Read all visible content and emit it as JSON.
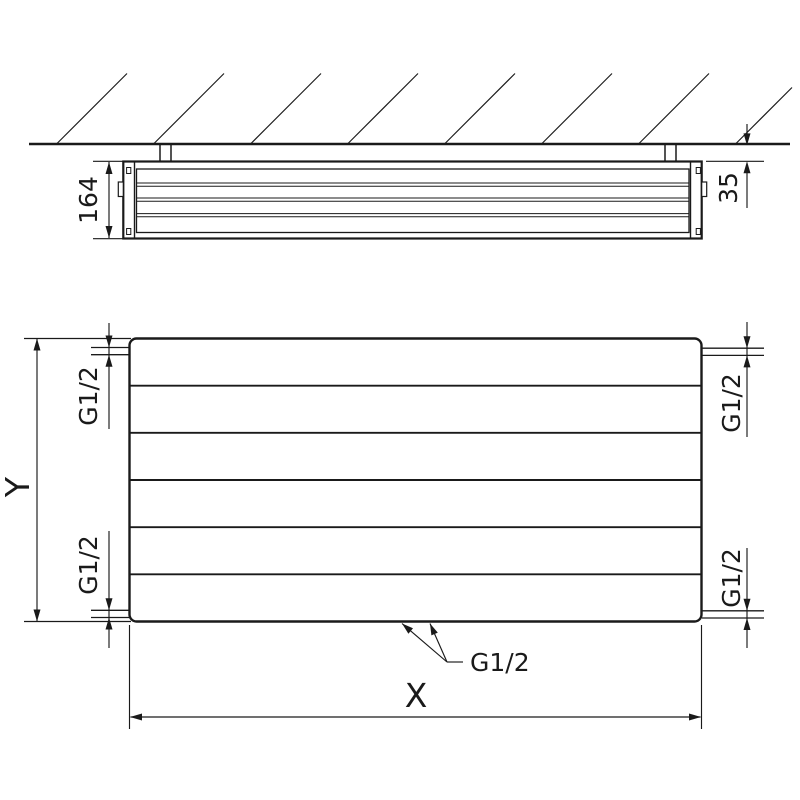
{
  "drawing": {
    "description": "Panel radiator installation dimension drawing: ceiling cross-section view and front view",
    "colors": {
      "line": "#1a1a1a",
      "background": "#ffffff"
    },
    "top_view": {
      "depth_label": "164",
      "wall_distance_label": "35"
    },
    "front_view": {
      "height_label": "Y",
      "width_label": "X",
      "thread_top_left": "G1/2",
      "thread_bottom_left": "G1/2",
      "thread_top_right": "G1/2",
      "thread_bottom_right": "G1/2",
      "thread_bottom_center": "G1/2"
    }
  }
}
